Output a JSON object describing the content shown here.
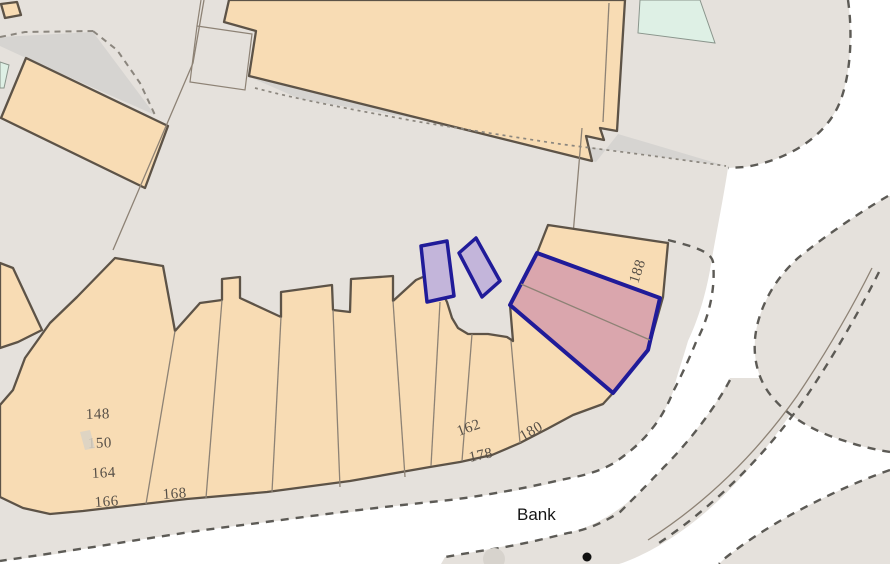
{
  "map": {
    "kind": "cadastral-parcel-map",
    "labels": [
      {
        "text": "148"
      },
      {
        "text": "150"
      },
      {
        "text": "164"
      },
      {
        "text": "166"
      },
      {
        "text": "168"
      },
      {
        "text": "162"
      },
      {
        "text": "178"
      },
      {
        "text": "180"
      },
      {
        "text": "188"
      },
      {
        "text": "Bank"
      }
    ]
  },
  "colors": {
    "land": "#e5e1dc",
    "land-dark": "#d6d4d1",
    "tan": "#f8dcb4",
    "outline": "#5d5347",
    "wall": "#8d8275",
    "navy": "#201b99",
    "purple": "#c3b5da",
    "pink": "#daa6ad",
    "mint": "#def0e5",
    "dash": "#5c5a55",
    "dash-light": "#8b867e",
    "label": "#564f47",
    "bank": "#151515"
  }
}
